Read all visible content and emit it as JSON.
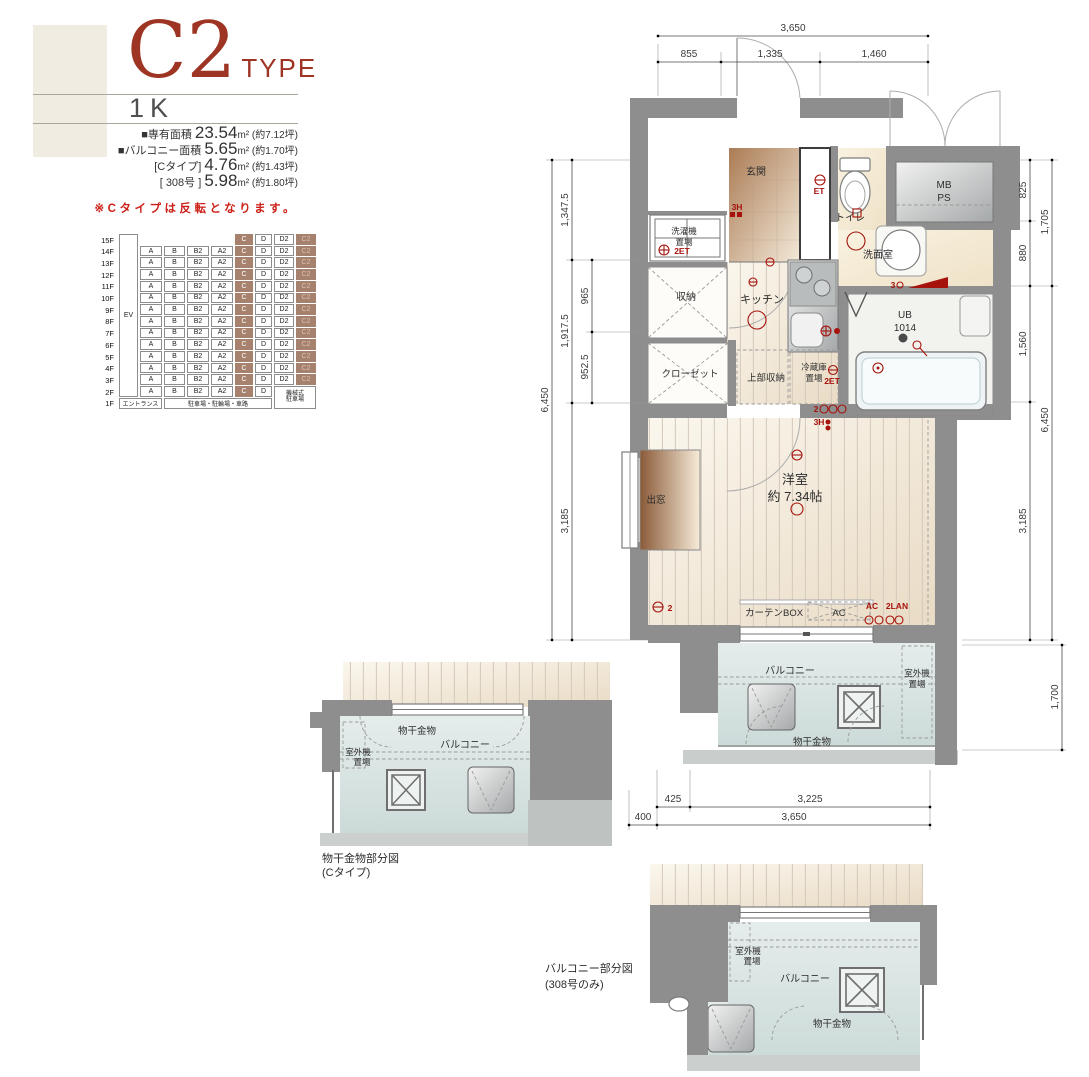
{
  "header": {
    "type_main": "C2",
    "type_suffix": "TYPE",
    "layout": "1K",
    "area_lines": [
      {
        "prefix": "■専有面積 ",
        "number": "23.54",
        "suffix": "m² (約7.12坪)"
      },
      {
        "prefix": "■バルコニー面積 ",
        "number": "5.65",
        "suffix": "m² (約1.70坪)"
      },
      {
        "prefix": "[Cタイプ] ",
        "number": "4.76",
        "suffix": "m² (約1.43坪)"
      },
      {
        "prefix": "[ 308号 ] ",
        "number": "5.98",
        "suffix": "m² (約1.80坪)"
      }
    ],
    "note": "※Cタイプは反転となります。"
  },
  "floor_table": {
    "ev": "EV",
    "entrance": "エントランス",
    "parking": "駐車場・駐輪場・車路",
    "mech_line1": "機械式",
    "mech_line2": "駐車場",
    "rows": [
      {
        "floor": "15F",
        "cells": [
          "",
          "",
          "",
          "",
          "C",
          "D",
          "D2",
          "C2"
        ]
      },
      {
        "floor": "14F",
        "cells": [
          "A",
          "B",
          "B2",
          "A2",
          "C",
          "D",
          "D2",
          "C2"
        ]
      },
      {
        "floor": "13F",
        "cells": [
          "A",
          "B",
          "B2",
          "A2",
          "C",
          "D",
          "D2",
          "C2"
        ]
      },
      {
        "floor": "12F",
        "cells": [
          "A",
          "B",
          "B2",
          "A2",
          "C",
          "D",
          "D2",
          "C2"
        ]
      },
      {
        "floor": "11F",
        "cells": [
          "A",
          "B",
          "B2",
          "A2",
          "C",
          "D",
          "D2",
          "C2"
        ]
      },
      {
        "floor": "10F",
        "cells": [
          "A",
          "B",
          "B2",
          "A2",
          "C",
          "D",
          "D2",
          "C2"
        ]
      },
      {
        "floor": "9F",
        "cells": [
          "A",
          "B",
          "B2",
          "A2",
          "C",
          "D",
          "D2",
          "C2"
        ]
      },
      {
        "floor": "8F",
        "cells": [
          "A",
          "B",
          "B2",
          "A2",
          "C",
          "D",
          "D2",
          "C2"
        ]
      },
      {
        "floor": "7F",
        "cells": [
          "A",
          "B",
          "B2",
          "A2",
          "C",
          "D",
          "D2",
          "C2"
        ]
      },
      {
        "floor": "6F",
        "cells": [
          "A",
          "B",
          "B2",
          "A2",
          "C",
          "D",
          "D2",
          "C2"
        ]
      },
      {
        "floor": "5F",
        "cells": [
          "A",
          "B",
          "B2",
          "A2",
          "C",
          "D",
          "D2",
          "C2"
        ]
      },
      {
        "floor": "4F",
        "cells": [
          "A",
          "B",
          "B2",
          "A2",
          "C",
          "D",
          "D2",
          "C2"
        ]
      },
      {
        "floor": "3F",
        "cells": [
          "A",
          "B",
          "B2",
          "A2",
          "C",
          "D",
          "D2",
          "C2"
        ]
      },
      {
        "floor": "2F",
        "cells": [
          "A",
          "B",
          "B2",
          "A2",
          "C",
          "D",
          "",
          ""
        ]
      },
      {
        "floor": "1F",
        "cells": []
      }
    ]
  },
  "plan": {
    "genkan": "玄関",
    "shoes": "シューズボックス",
    "toilet": "トイレ",
    "mb1": "MB",
    "mb2": "PS",
    "washroom": "洗面室",
    "washer1": "洗濯機",
    "washer2": "置場",
    "storage": "収納",
    "kitchen": "キッチン",
    "closet": "クローゼット",
    "upper_storage": "上部収納",
    "fridge1": "冷蔵庫",
    "fridge2": "置場",
    "ub1": "UB",
    "ub2": "1014",
    "room1": "洋室",
    "room2": "約 7.34帖",
    "bay": "出窓",
    "curtain": "カーテンBOX",
    "ac": "AC",
    "balcony": "バルコニー",
    "outdoor1": "室外機",
    "outdoor2": "置場",
    "laundry": "物干金物",
    "ann": {
      "h3_entry": "3H",
      "et_toilet": "ET",
      "et_washer": "2ET",
      "et_fridge": "2ET",
      "n2_kitchen": "2",
      "h3_kitchen": "3H",
      "ac": "AC",
      "lan": "2LAN",
      "n3_wash": "3",
      "n2_room": "2"
    }
  },
  "dims": {
    "top": {
      "total": "3,650",
      "segs": [
        "855",
        "1,335",
        "1,460"
      ]
    },
    "left": {
      "total": "6,450",
      "segs": [
        "1,347.5",
        "1,917.5",
        "3,185"
      ],
      "inner": [
        "965",
        "952.5"
      ]
    },
    "right": {
      "total": "6,450",
      "outer": "1,705",
      "segs": [
        "825",
        "880",
        "1,560",
        "3,185"
      ],
      "balcony": "1,700"
    },
    "bottom": {
      "upper": [
        "425",
        "3,225"
      ],
      "lower": [
        "400",
        "3,650"
      ]
    }
  },
  "sub_c": {
    "caption1": "物干金物部分図",
    "caption2": "(Cタイプ)",
    "balcony": "バルコニー",
    "laundry": "物干金物",
    "outdoor1": "室外機",
    "outdoor2": "置場"
  },
  "sub_308": {
    "caption1": "バルコニー部分図",
    "caption2": "(308号のみ)",
    "balcony": "バルコニー",
    "laundry": "物干金物",
    "outdoor1": "室外機",
    "outdoor2": "置場"
  },
  "colors": {
    "accent_red": "#9e3423",
    "note_red": "#cb1f17",
    "highlight_brown": "#a6826e",
    "wall_gray": "#8e8e8e",
    "annotation_red": "#a6120c"
  }
}
